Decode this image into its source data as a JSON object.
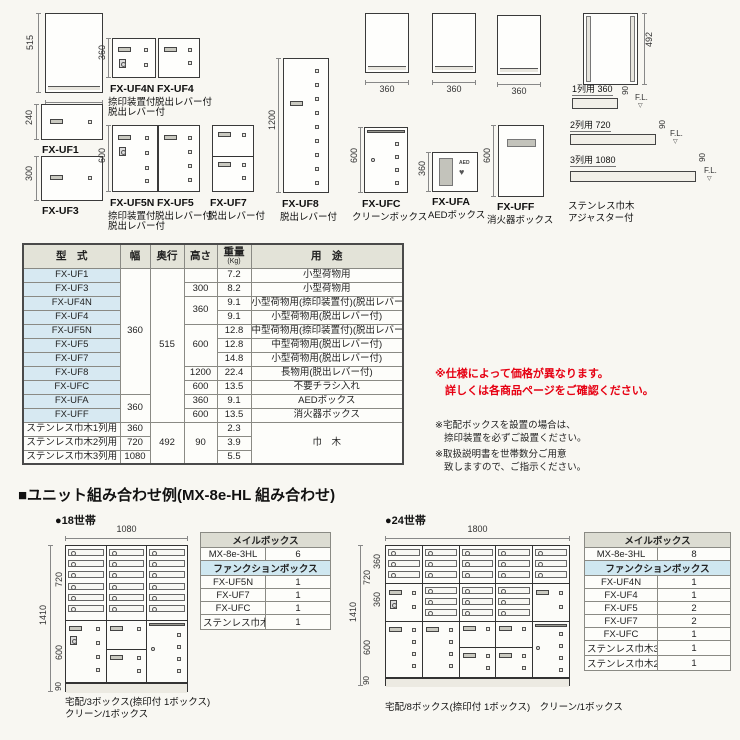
{
  "top": {
    "fl_mark": "▽",
    "persp1": {
      "h": "515",
      "w": "360"
    },
    "uf1": {
      "label": "FX-UF1",
      "h": "240"
    },
    "uf3": {
      "label": "FX-UF3",
      "h": "300"
    },
    "uf4n": {
      "label": "FX-UF4N",
      "sub1": "捺印装置付",
      "sub2": "脱出レバー付",
      "h": "360"
    },
    "uf4": {
      "label": "FX-UF4",
      "sub1": "脱出レバー付"
    },
    "uf5n": {
      "label": "FX-UF5N",
      "sub1": "捺印装置付",
      "sub2": "脱出レバー付",
      "h": "600"
    },
    "uf5": {
      "label": "FX-UF5",
      "sub1": "脱出レバー付"
    },
    "uf7": {
      "label": "FX-UF7",
      "sub1": "脱出レバー付"
    },
    "uf8": {
      "label": "FX-UF8",
      "sub1": "脱出レバー付",
      "h": "1200"
    },
    "persp2": {
      "w": "360"
    },
    "persp3": {
      "w": "360"
    },
    "persp4": {
      "w": "360"
    },
    "ufc": {
      "label": "FX-UFC",
      "sub1": "クリーンボックス",
      "h": "600"
    },
    "ufa": {
      "label": "FX-UFA",
      "sub1": "AEDボックス",
      "h": "360",
      "aed": "AED",
      "heart": "♥"
    },
    "uff": {
      "label": "FX-UFF",
      "sub1": "消火器ボックス",
      "h": "600"
    },
    "frame": {
      "h": "492"
    },
    "skirts": [
      {
        "label": "1列用 360",
        "h": "90",
        "fl": "F.L."
      },
      {
        "label": "2列用 720",
        "h": "90",
        "fl": "F.L."
      },
      {
        "label": "3列用 1080",
        "h": "90",
        "fl": "F.L."
      }
    ],
    "skirt_name1": "ステンレス巾木",
    "skirt_name2": "アジャスター付"
  },
  "spec": {
    "h_model": "型　式",
    "h_width": "幅",
    "h_depth": "奥行",
    "h_height": "高さ",
    "h_weight": "重量",
    "h_weight_unit": "(Kg)",
    "h_use": "用　途",
    "width_a": "360",
    "width_b": "360",
    "depth_a": "515",
    "depth_b": "492",
    "hgt": {
      "r0": "",
      "r1": "300",
      "r23": "360",
      "r456": "600",
      "r7": "1200",
      "r8": "600",
      "r9": "360",
      "r10": "600",
      "skirt": "90"
    },
    "use_skirt": "巾　木",
    "rows": [
      {
        "model": "FX-UF1",
        "w": "7.2",
        "use": "小型荷物用"
      },
      {
        "model": "FX-UF3",
        "w": "8.2",
        "use": "小型荷物用"
      },
      {
        "model": "FX-UF4N",
        "w": "9.1",
        "use": "小型荷物用(捺印装置付)(脱出レバー付)"
      },
      {
        "model": "FX-UF4",
        "w": "9.1",
        "use": "小型荷物用(脱出レバー付)"
      },
      {
        "model": "FX-UF5N",
        "w": "12.8",
        "use": "中型荷物用(捺印装置付)(脱出レバー付)"
      },
      {
        "model": "FX-UF5",
        "w": "12.8",
        "use": "中型荷物用(脱出レバー付)"
      },
      {
        "model": "FX-UF7",
        "w": "14.8",
        "use": "小型荷物用(脱出レバー付)"
      },
      {
        "model": "FX-UF8",
        "w": "22.4",
        "use": "長物用(脱出レバー付)"
      },
      {
        "model": "FX-UFC",
        "w": "13.5",
        "use": "不要チラシ入れ"
      },
      {
        "model": "FX-UFA",
        "w": "9.1",
        "use": "AEDボックス"
      },
      {
        "model": "FX-UFF",
        "w": "13.5",
        "use": "消火器ボックス"
      },
      {
        "model": "ステンレス巾木1列用",
        "skw": "360",
        "w": "2.3"
      },
      {
        "model": "ステンレス巾木2列用",
        "skw": "720",
        "w": "3.9"
      },
      {
        "model": "ステンレス巾木3列用",
        "skw": "1080",
        "w": "5.5"
      }
    ]
  },
  "notes": {
    "red1": "※仕様によって価格が異なります。",
    "red2": "詳しくは各商品ページをご確認ください。",
    "n1a": "※宅配ボックスを設置の場合は、",
    "n1b": "捺印装置を必ずご設置ください。",
    "n2a": "※取扱説明書を世帯数分ご用意",
    "n2b": "致しますので、ご指示ください。"
  },
  "combos": {
    "title": "■ユニット組み合わせ例(MX-8e-HL 組み合わせ)",
    "c18": {
      "label": "●18世帯",
      "dim_w": "1080",
      "dim_total": "1410",
      "dim_mail": "720",
      "dim_parcel": "600",
      "dim_base": "90",
      "cap1": "宅配/3ボックス(捺印付 1ボックス)",
      "cap2": "クリーン/1ボックス",
      "table": {
        "mail_header": "メイルボックス",
        "mail_rows": [
          {
            "name": "MX-8e-3HL",
            "qty": "6"
          }
        ],
        "func_header": "ファンクションボックス",
        "func_rows": [
          {
            "name": "FX-UF5N",
            "qty": "1"
          },
          {
            "name": "FX-UF7",
            "qty": "1"
          },
          {
            "name": "FX-UFC",
            "qty": "1"
          },
          {
            "name": "ステンレス巾木3列用",
            "qty": "1"
          }
        ]
      }
    },
    "c24": {
      "label": "●24世帯",
      "dim_w": "1800",
      "dim_total": "1410",
      "dim_mail": "720",
      "dim_m1": "360",
      "dim_m2": "360",
      "dim_parcel": "600",
      "dim_base": "90",
      "cap1": "宅配/8ボックス(捺印付 1ボックス)　クリーン/1ボックス",
      "table": {
        "mail_header": "メイルボックス",
        "mail_rows": [
          {
            "name": "MX-8e-3HL",
            "qty": "8"
          }
        ],
        "func_header": "ファンクションボックス",
        "func_rows": [
          {
            "name": "FX-UF4N",
            "qty": "1"
          },
          {
            "name": "FX-UF4",
            "qty": "1"
          },
          {
            "name": "FX-UF5",
            "qty": "2"
          },
          {
            "name": "FX-UF7",
            "qty": "2"
          },
          {
            "name": "FX-UFC",
            "qty": "1"
          },
          {
            "name": "ステンレス巾木3列用",
            "qty": "1"
          },
          {
            "name": "ステンレス巾木2列用",
            "qty": "1"
          }
        ]
      }
    }
  }
}
